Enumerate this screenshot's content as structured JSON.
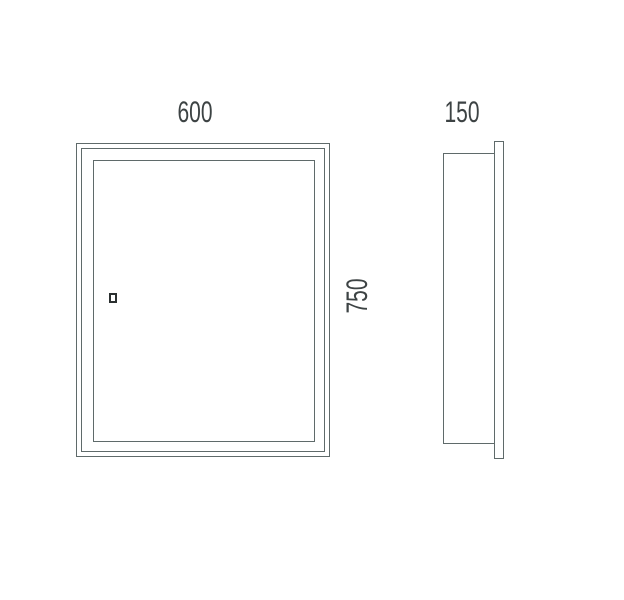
{
  "drawing": {
    "type": "technical-dimension-drawing",
    "views": {
      "front": {
        "width_dim": "600",
        "height_dim": "750"
      },
      "side": {
        "depth_dim": "150"
      }
    },
    "colors": {
      "line": "#5f6a6a",
      "dim_text": "#3d4344",
      "handle": "#2b3030",
      "background": "#ffffff"
    }
  }
}
